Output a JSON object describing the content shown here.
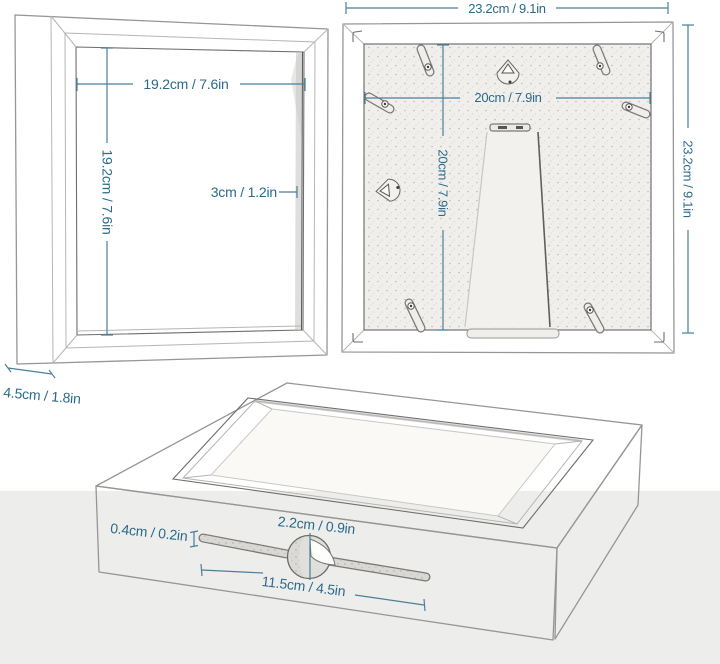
{
  "colors": {
    "dimension_text": "#2b6a8a",
    "dimension_line": "#4a7f99",
    "sketch_line": "#969696",
    "floor": "#ededec",
    "backboard": "#f0efec"
  },
  "front_view": {
    "width_label": "19.2cm / 7.6in",
    "height_label": "19.2cm / 7.6in",
    "depth_label": "3cm / 1.2in",
    "frame_depth_label": "4.5cm / 1.8in"
  },
  "back_view": {
    "outer_width_label": "23.2cm / 9.1in",
    "outer_height_label": "23.2cm / 9.1in",
    "board_width_label": "20cm / 7.9in",
    "board_height_label": "20cm / 7.9in"
  },
  "perspective_view": {
    "slot_height_label": "0.4cm / 0.2in",
    "hole_diameter_label": "2.2cm / 0.9in",
    "slot_length_label": "11.5cm / 4.5in"
  }
}
